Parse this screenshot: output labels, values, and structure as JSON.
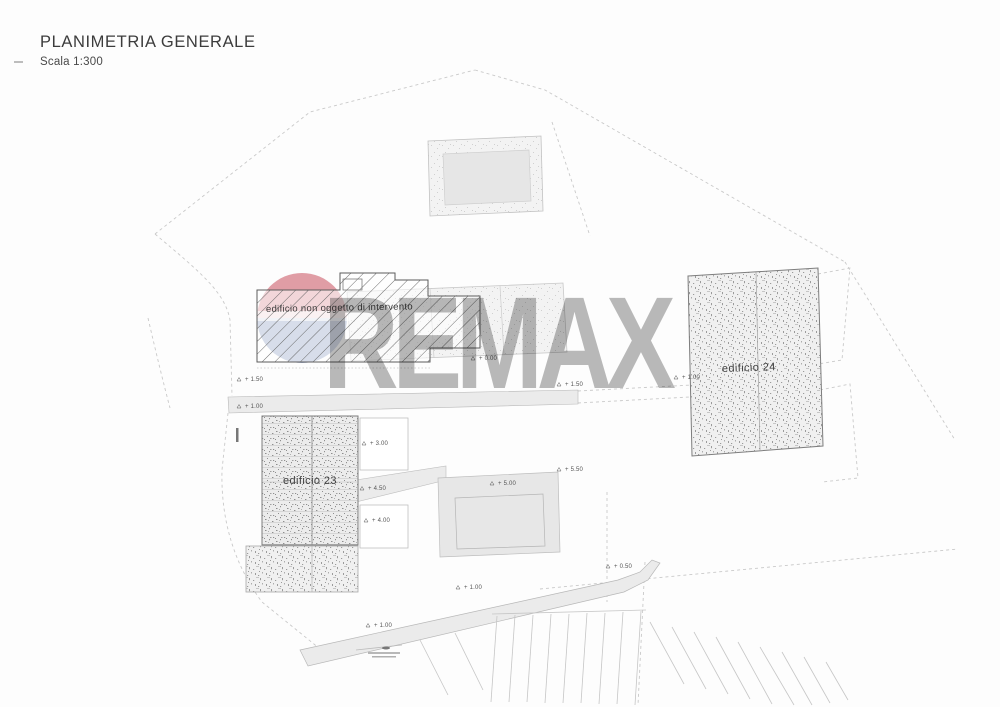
{
  "header": {
    "title": "PLANIMETRIA GENERALE",
    "scale": "Scala 1:300"
  },
  "watermark": {
    "text": "REMAX",
    "color": "#a9a9a9"
  },
  "logo": {
    "name": "remax-balloon",
    "top_color": "#c94f5c",
    "bottom_color": "#44619c"
  },
  "plan": {
    "buildings": [
      {
        "id": "edificio-non-oggetto",
        "label": "edificio non oggetto di intervento",
        "texture": "diagonal-hatch"
      },
      {
        "id": "edificio-23",
        "label": "edificio 23",
        "texture": "dense-stipple"
      },
      {
        "id": "edificio-24",
        "label": "edificio 24",
        "texture": "stipple"
      }
    ],
    "elevation_markers": [
      {
        "value": "+ 1.50",
        "x": 245,
        "y": 381
      },
      {
        "value": "+ 1.00",
        "x": 245,
        "y": 408
      },
      {
        "value": "+ 0.00",
        "x": 479,
        "y": 360
      },
      {
        "value": "+ 1.50",
        "x": 565,
        "y": 386
      },
      {
        "value": "+ 3.00",
        "x": 370,
        "y": 445
      },
      {
        "value": "+ 4.50",
        "x": 368,
        "y": 490
      },
      {
        "value": "+ 4.00",
        "x": 372,
        "y": 522
      },
      {
        "value": "+ 5.00",
        "x": 498,
        "y": 485
      },
      {
        "value": "+ 5.50",
        "x": 565,
        "y": 471
      },
      {
        "value": "+ 1.00",
        "x": 682,
        "y": 379
      },
      {
        "value": "+ 1.00",
        "x": 464,
        "y": 589
      },
      {
        "value": "+ 0.50",
        "x": 614,
        "y": 568
      },
      {
        "value": "+ 1.00",
        "x": 374,
        "y": 627
      }
    ]
  }
}
